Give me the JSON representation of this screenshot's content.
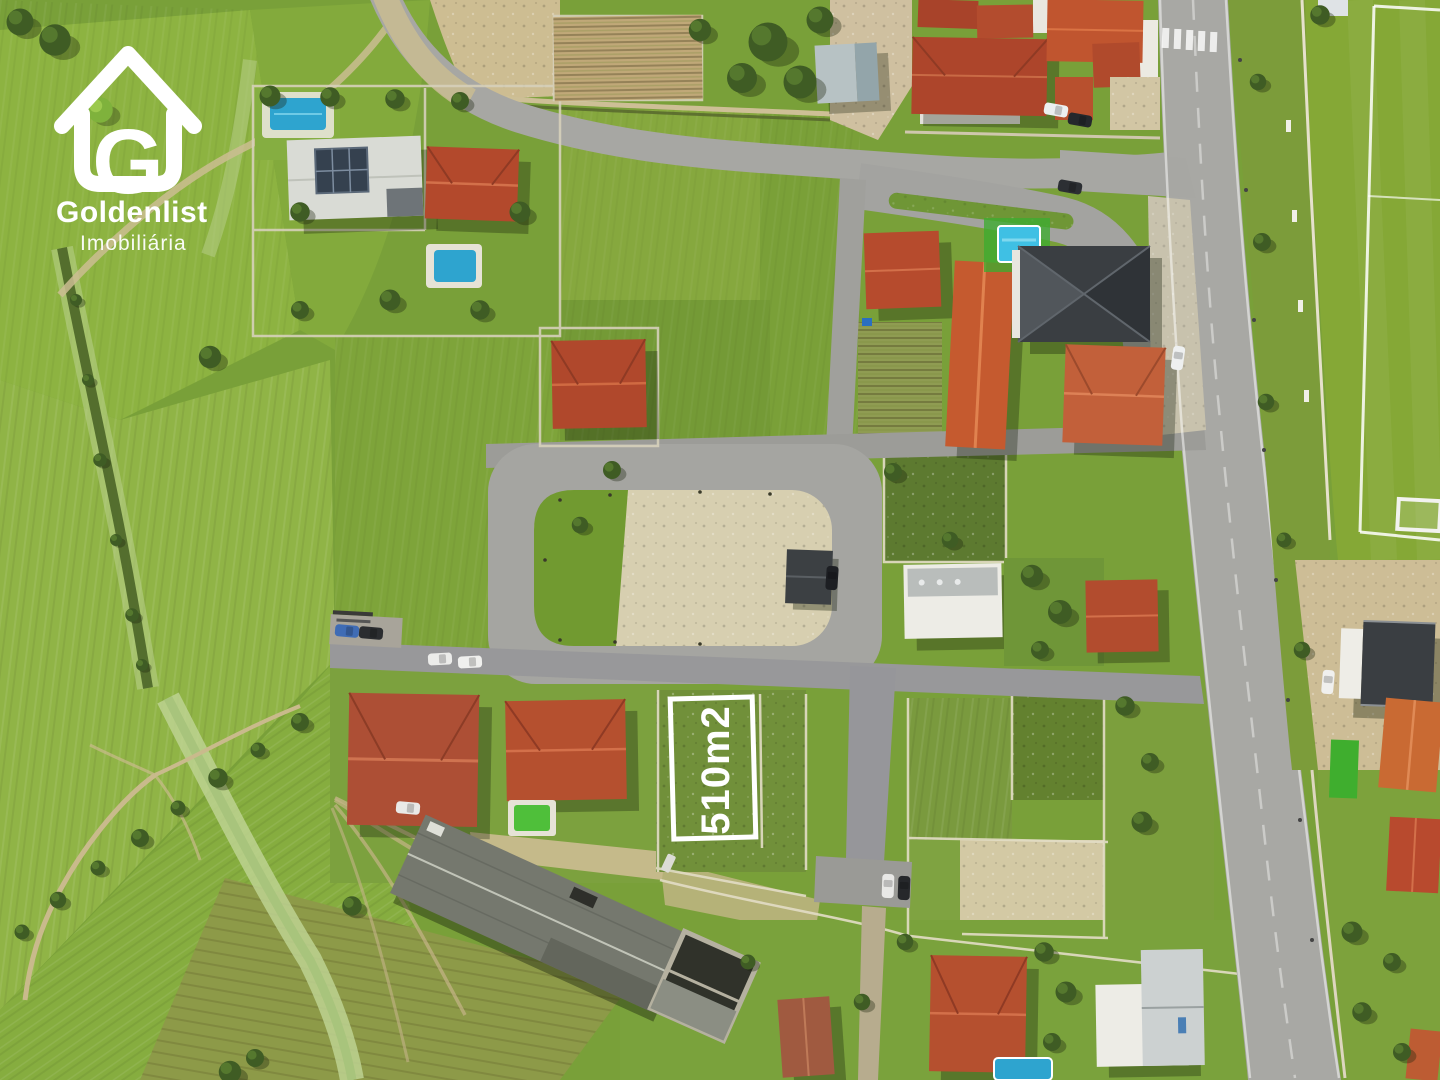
{
  "watermark": {
    "icon": "house-logo-icon",
    "logo_letter": "G",
    "brand": "Goldenlist",
    "tagline": "Imobiliária",
    "text_color": "#ffffff"
  },
  "plot_marker": {
    "label": "510m2",
    "outline_color": "#ffffff",
    "text_color": "#ffffff"
  },
  "palette": {
    "field_green": "#79a039",
    "bright_field": "#8db341",
    "scrub_green": "#5d7a30",
    "road_asphalt": "#a3a3a0",
    "main_road": "#a8a8a4",
    "plaza_sand": "#d7cfb0",
    "roof_terracotta": "#b5502f",
    "roof_orange": "#c96a33",
    "roof_dark": "#3a3e42",
    "warehouse_gray": "#75786e",
    "pool_blue": "#2ea4cf",
    "pool_green": "#4fbf3a",
    "pitch_green": "#85a836",
    "white_building": "#edece6"
  }
}
